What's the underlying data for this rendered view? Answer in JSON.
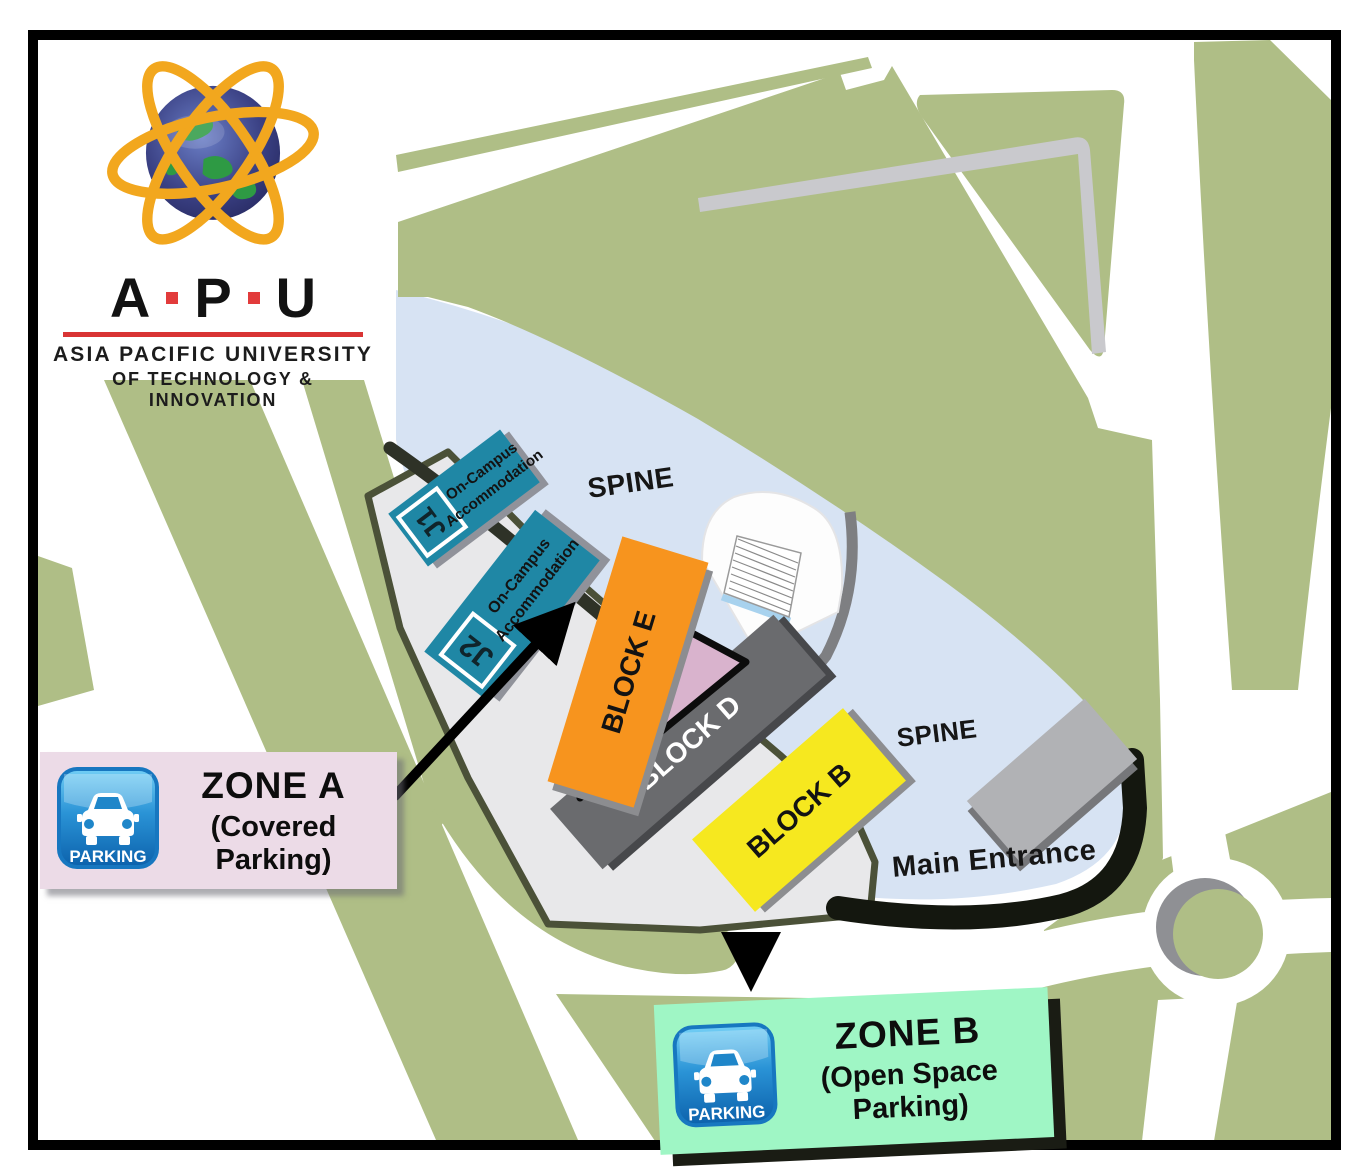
{
  "logo": {
    "letters": [
      "A",
      "P",
      "U"
    ],
    "line1": "ASIA PACIFIC UNIVERSITY",
    "line2": "OF TECHNOLOGY & INNOVATION"
  },
  "map": {
    "spine_upper": "SPINE",
    "spine_lower": "SPINE",
    "main_entrance": "Main Entrance",
    "buildings": {
      "j1_code": "J1",
      "j1_label_line1": "On-Campus",
      "j1_label_line2": "Accommodation",
      "j2_code": "J2",
      "j2_label_line1": "On-Campus",
      "j2_label_line2": "Accommodation",
      "block_e": "BLOCK E",
      "block_d": "BLOCK D",
      "block_b": "BLOCK B"
    },
    "colors": {
      "grass_green": "#afbe86",
      "road_white": "#ffffff",
      "footpath_gray": "#c9c9cd",
      "spine_blue": "#d7e3f3",
      "campus_ground_gray": "#e8e8ea",
      "accommodation_teal": "#1f87a5",
      "block_e_orange": "#f7941e",
      "block_d_gray": "#6a6b6e",
      "block_b_yellow": "#f6e81f",
      "annex_pink": "#d9b3cd",
      "utility_building_gray": "#b1b2b5",
      "zone_a_bg": "#ecdbe7",
      "zone_b_bg": "#9ff6c5",
      "parking_icon_blue": "#1372bd"
    }
  },
  "zone_a": {
    "parking_label": "PARKING",
    "title": "ZONE A",
    "subtitle": "(Covered Parking)"
  },
  "zone_b": {
    "parking_label": "PARKING",
    "title": "ZONE B",
    "subtitle": "(Open Space Parking)"
  }
}
